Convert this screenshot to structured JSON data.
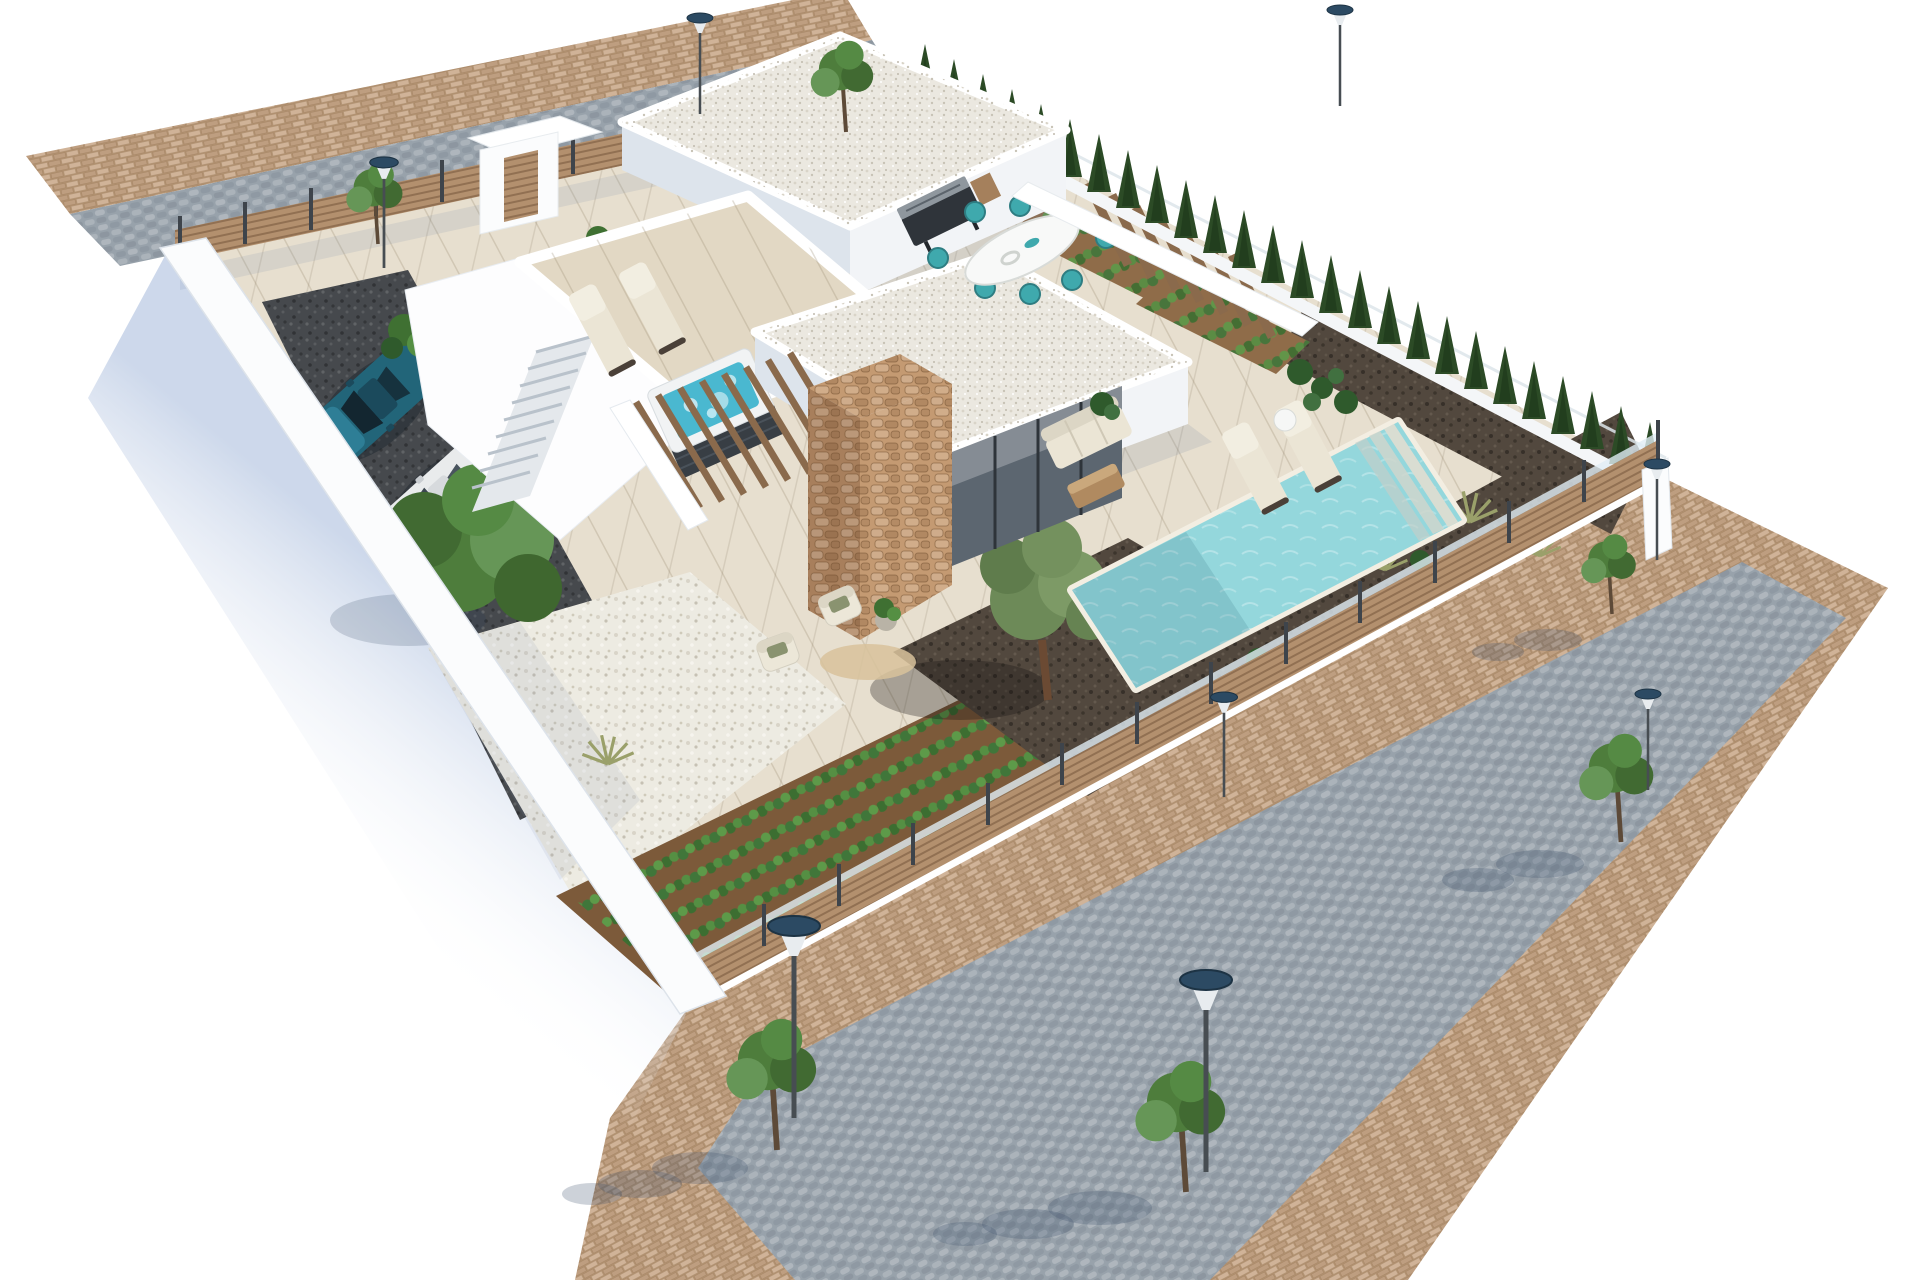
{
  "meta": {
    "view": "isometric-aerial-3d-render",
    "subject": "modern-villa-plot"
  },
  "palette": {
    "background": "#ffffff",
    "road_gray": "#98a2ab",
    "sidewalk_tan": "#c9a98a",
    "lot_beige": "#e7dfcf",
    "deck_beige": "#e2d8c4",
    "gravel_white": "#edebe2",
    "gravel_dark": "#46494d",
    "soil_brown": "#7c5a3a",
    "soil_light": "#8f6c49",
    "mulch_dark": "#52483e",
    "pool_water": "#94d7dc",
    "pool_steps": "#d9ddd2",
    "jacuzzi_water": "#4ab8d0",
    "wood_fence": "#b3906e",
    "wood_pergola": "#8a6a4c",
    "stone_tan": "#c49a72",
    "stone_shade": "#a87f5c",
    "wall_white": "#ffffff",
    "wall_light": "#f2f4f7",
    "wall_shade": "#dde4ec",
    "roof_gravel": "#ebe8e0",
    "cypress_green": "#2c4b26",
    "hedge_green": "#3c6830",
    "tree_green": "#4e7d3c",
    "tree_green_light": "#669657",
    "olive_green": "#6d8a58",
    "crop_green": "#46793a",
    "car_teal": "#226579",
    "car_white": "#e9ebec",
    "glass_dark": "#5c6670",
    "chair_teal": "#3fa9ad",
    "lounger_cream": "#ebe5d5",
    "table_white": "#f8f9f8",
    "rug_tan": "#d8c29b",
    "lamp_head": "#2c4a63",
    "lamp_pole": "#474d52"
  },
  "scene": {
    "lot_shape": "quadrilateral",
    "objects": [
      "modern-villa",
      "flat-gravel-roofs",
      "rooftop-terrace",
      "jacuzzi",
      "sun-loungers",
      "swimming-pool-with-steps",
      "outdoor-dining-table",
      "teal-dining-chairs",
      "bbq-grill",
      "outdoor-sofa",
      "stone-clad-column",
      "entrance-portal",
      "wooden-pergola-slats",
      "exterior-staircase",
      "teal-car",
      "white-car",
      "gravel-driveway",
      "white-gravel-garden",
      "vegetable-garden-rows",
      "olive-tree",
      "mulch-beds",
      "cypress-row",
      "hedge-row",
      "wooden-fence",
      "glass-balustrade",
      "street-lamps",
      "street-trees",
      "cobblestone-road",
      "brick-paver-sidewalk"
    ]
  }
}
